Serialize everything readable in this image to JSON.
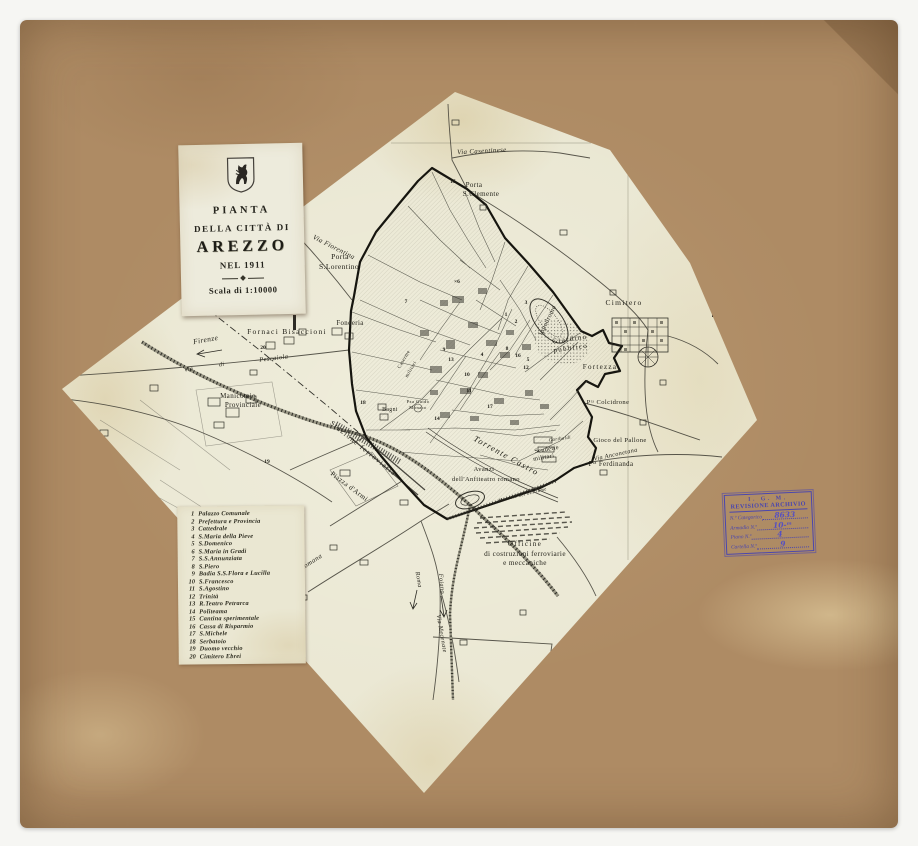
{
  "colors": {
    "board": "#ae8b64",
    "sheet": "#e9e6d1",
    "ink": "#23221a",
    "stamp_ink": "#4a46ae"
  },
  "title_card": {
    "lines": [
      "PIANTA",
      "DELLA CITTÀ DI",
      "AREZZO",
      "NEL 1911",
      "Scala di 1:10000"
    ],
    "emblem": "rampant-horse-shield"
  },
  "legend": {
    "items": [
      {
        "n": "1",
        "name": "Palazzo Comunale"
      },
      {
        "n": "2",
        "name": "Prefettura e Provincia"
      },
      {
        "n": "3",
        "name": "Cattedrale"
      },
      {
        "n": "4",
        "name": "S.Maria della Pieve"
      },
      {
        "n": "5",
        "name": "S.Domenico"
      },
      {
        "n": "6",
        "name": "S.Maria in Gradi"
      },
      {
        "n": "7",
        "name": "S.S.Annunziata"
      },
      {
        "n": "8",
        "name": "S.Piero"
      },
      {
        "n": "9",
        "name": "Badia S.S.Flora e Lucilla"
      },
      {
        "n": "10",
        "name": "S.Francesco"
      },
      {
        "n": "11",
        "name": "S.Agostino"
      },
      {
        "n": "12",
        "name": "Trinità"
      },
      {
        "n": "13",
        "name": "R.Teatro Petrarca"
      },
      {
        "n": "14",
        "name": "Politeama"
      },
      {
        "n": "15",
        "name": "Cantina sperimentale"
      },
      {
        "n": "16",
        "name": "Cassa di Risparmio"
      },
      {
        "n": "17",
        "name": "S.Michele"
      },
      {
        "n": "18",
        "name": "Serbatoio"
      },
      {
        "n": "19",
        "name": "Duomo vecchio"
      },
      {
        "n": "20",
        "name": "Cimitero Ebrei"
      }
    ]
  },
  "stamp": {
    "org": "I. G. M.",
    "title": "REVISIONE ARCHIVIO",
    "rows": [
      {
        "label": "N.º Categorico",
        "value": "8633"
      },
      {
        "label": "Armadio N.º",
        "value": "10-ᵐ"
      },
      {
        "label": "Piano N.º",
        "value": "4"
      },
      {
        "label": "Cartella N.º",
        "value": "9"
      }
    ]
  },
  "map": {
    "labels": [
      {
        "t": "Via Casentinese",
        "x": 482,
        "y": 153,
        "r": -3,
        "s": 6.8,
        "c": "it"
      },
      {
        "t": "Porta",
        "x": 474,
        "y": 187,
        "r": 0,
        "s": 7,
        "c": ""
      },
      {
        "t": "S.Clemente",
        "x": 481,
        "y": 196,
        "r": 0,
        "s": 7,
        "c": ""
      },
      {
        "t": "Via Fiorentina",
        "x": 333,
        "y": 249,
        "r": 27,
        "s": 7,
        "c": "it"
      },
      {
        "t": "Porta",
        "x": 340,
        "y": 259,
        "r": 0,
        "s": 7.5,
        "c": ""
      },
      {
        "t": "S.Lorentino",
        "x": 339,
        "y": 269,
        "r": 0,
        "s": 7.5,
        "c": ""
      },
      {
        "t": "Fornaci Bisaccioni",
        "x": 287,
        "y": 334,
        "r": 0,
        "s": 7.5,
        "c": "sp"
      },
      {
        "t": "Fonderia",
        "x": 350,
        "y": 325,
        "r": 0,
        "s": 6.8,
        "c": ""
      },
      {
        "t": "Firenze",
        "x": 206,
        "y": 342,
        "r": -10,
        "s": 7.5,
        "c": "it"
      },
      {
        "t": "Pescaiola",
        "x": 274,
        "y": 360,
        "r": -7,
        "s": 6.5,
        "c": "it"
      },
      {
        "t": "Via",
        "x": 189,
        "y": 371,
        "r": -10,
        "s": 6,
        "c": "it"
      },
      {
        "t": "di",
        "x": 222,
        "y": 366,
        "r": -10,
        "s": 6,
        "c": "it"
      },
      {
        "t": "Manicomio",
        "x": 238,
        "y": 398,
        "r": 0,
        "s": 7,
        "c": ""
      },
      {
        "t": "Provinciale",
        "x": 243,
        "y": 407,
        "r": 0,
        "s": 7,
        "c": ""
      },
      {
        "t": "Ippodromo",
        "x": 549,
        "y": 321,
        "r": -64,
        "s": 6.5,
        "c": ""
      },
      {
        "t": "Giardino",
        "x": 570,
        "y": 341,
        "r": -8,
        "s": 7,
        "c": "sp"
      },
      {
        "t": "pubblico",
        "x": 571,
        "y": 350,
        "r": -8,
        "s": 7,
        "c": "sp"
      },
      {
        "t": "Cimitero",
        "x": 624,
        "y": 305,
        "r": 0,
        "s": 7.5,
        "c": "sp"
      },
      {
        "t": "Fortezza",
        "x": 600,
        "y": 369,
        "r": 0,
        "s": 7,
        "c": "sp"
      },
      {
        "t": "Pᵗᵃ Colcidrone",
        "x": 608,
        "y": 404,
        "r": 0,
        "s": 6.5,
        "c": ""
      },
      {
        "t": "Gioco del Pallone",
        "x": 620,
        "y": 442,
        "r": 0,
        "s": 6.5,
        "c": ""
      },
      {
        "t": "Via Anconetana",
        "x": 616,
        "y": 456,
        "r": -12,
        "s": 6.2,
        "c": "it"
      },
      {
        "t": "Pᵗᵃ Ferdinanda",
        "x": 611,
        "y": 466,
        "r": 0,
        "s": 6.8,
        "c": ""
      },
      {
        "t": "Scuderie",
        "x": 547,
        "y": 451,
        "r": -10,
        "s": 6.2,
        "c": ""
      },
      {
        "t": "militari",
        "x": 544,
        "y": 459,
        "r": -10,
        "s": 6.2,
        "c": ""
      },
      {
        "t": "Garibaldi",
        "x": 560,
        "y": 440,
        "r": -8,
        "s": 4.8,
        "c": "it"
      },
      {
        "t": "Torrente Castro",
        "x": 505,
        "y": 458,
        "r": 29,
        "s": 8.5,
        "c": "it sp"
      },
      {
        "t": "Avanzi",
        "x": 484,
        "y": 471,
        "r": 0,
        "s": 6.5,
        "c": ""
      },
      {
        "t": "dell'Anfiteatro romano",
        "x": 486,
        "y": 481,
        "r": 0,
        "s": 6.5,
        "c": ""
      },
      {
        "t": "Mercato del bestiame",
        "x": 523,
        "y": 496,
        "r": -14,
        "s": 4.8,
        "c": "it"
      },
      {
        "t": "Stazione ferroviaria",
        "x": 362,
        "y": 450,
        "r": 39,
        "s": 7.2,
        "c": "sp"
      },
      {
        "t": "Piazza d'Armi",
        "x": 348,
        "y": 488,
        "r": 37,
        "s": 7,
        "c": ""
      },
      {
        "t": "Bagni",
        "x": 390,
        "y": 411,
        "r": 0,
        "s": 5.8,
        "c": ""
      },
      {
        "t": "Pza Guido",
        "x": 418,
        "y": 403,
        "r": 0,
        "s": 4.6,
        "c": ""
      },
      {
        "t": "Monaco",
        "x": 418,
        "y": 409,
        "r": 0,
        "s": 4.6,
        "c": ""
      },
      {
        "t": "Caserme",
        "x": 405,
        "y": 360,
        "r": -60,
        "s": 5,
        "c": ""
      },
      {
        "t": "militari",
        "x": 412,
        "y": 370,
        "r": -60,
        "s": 5,
        "c": ""
      },
      {
        "t": "Officine",
        "x": 525,
        "y": 546,
        "r": 0,
        "s": 7.2,
        "c": "sp"
      },
      {
        "t": "di costruzioni ferroviarie",
        "x": 525,
        "y": 556,
        "r": 0,
        "s": 7.2,
        "c": ""
      },
      {
        "t": "e meccaniche",
        "x": 525,
        "y": 565,
        "r": 0,
        "s": 7.2,
        "c": ""
      },
      {
        "t": "Via Romana",
        "x": 307,
        "y": 567,
        "r": -33,
        "s": 6.8,
        "c": "it"
      },
      {
        "t": "Roma",
        "x": 417,
        "y": 580,
        "r": 80,
        "s": 6.2,
        "c": "it"
      },
      {
        "t": "Foiano",
        "x": 440,
        "y": 584,
        "r": 84,
        "s": 6.2,
        "c": "it"
      },
      {
        "t": "Via Mecenate",
        "x": 440,
        "y": 634,
        "r": 80,
        "s": 6.2,
        "c": "it"
      }
    ],
    "markers": [
      {
        "t": "1",
        "x": 506,
        "y": 316
      },
      {
        "t": "2",
        "x": 516,
        "y": 323
      },
      {
        "t": "3",
        "x": 526,
        "y": 304
      },
      {
        "t": "4",
        "x": 482,
        "y": 356
      },
      {
        "t": "5",
        "x": 528,
        "y": 361
      },
      {
        "t": "×6",
        "x": 457,
        "y": 283
      },
      {
        "t": "7",
        "x": 406,
        "y": 303
      },
      {
        "t": "8",
        "x": 507,
        "y": 350
      },
      {
        "t": "9",
        "x": 444,
        "y": 351
      },
      {
        "t": "10",
        "x": 467,
        "y": 376
      },
      {
        "t": "11",
        "x": 469,
        "y": 392
      },
      {
        "t": "12",
        "x": 526,
        "y": 369
      },
      {
        "t": "13",
        "x": 451,
        "y": 361
      },
      {
        "t": "14",
        "x": 437,
        "y": 420
      },
      {
        "t": "15",
        "x": 453,
        "y": 183
      },
      {
        "t": "16",
        "x": 518,
        "y": 357
      },
      {
        "t": "17",
        "x": 490,
        "y": 408
      },
      {
        "t": "18",
        "x": 363,
        "y": 404
      },
      {
        "t": "19",
        "x": 267,
        "y": 463
      },
      {
        "t": "20",
        "x": 263,
        "y": 349
      }
    ]
  }
}
